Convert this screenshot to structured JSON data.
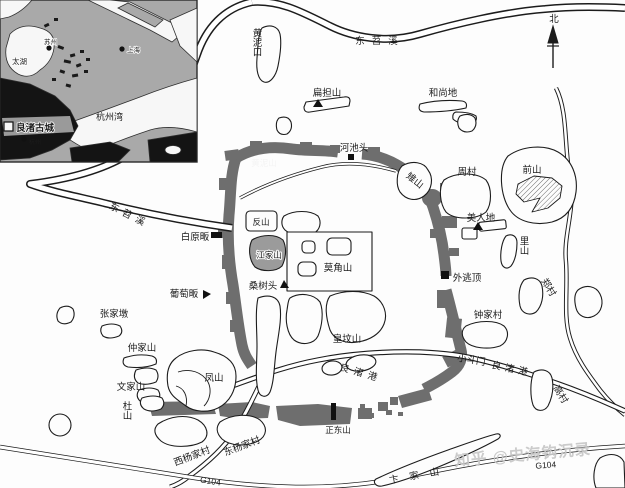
{
  "compass": {
    "north": "北"
  },
  "rivers": {
    "dongtiaoxi_top": "东苕溪",
    "dongtiaoxi_left": "东苕溪",
    "liangzhugang_mid": "良渚港",
    "liangzhugang_right": "良渚港"
  },
  "roads": {
    "g104_left": "G104",
    "g104_right": "G104"
  },
  "places": {
    "huangnikou": "黄泥口",
    "biandanshan": "扁担山",
    "heshangdi": "和尚地",
    "hechitou": "河池头",
    "huangnishan": "黄泥山",
    "zhishan": "雉山",
    "zhoucun": "周村",
    "qianshan": "前山",
    "meirendi": "美人地",
    "lishan": "里山",
    "baiyuanfan": "白原畈",
    "fanshan": "反山",
    "jiangjiashan": "江家山",
    "mojiaoshan": "莫角山",
    "putaofan": "葡萄畈",
    "sangshutou": "桑树头",
    "waitaoding": "外逃顶",
    "zhengcun": "郑村",
    "zhangjiadun": "张家墩",
    "huangfenshan": "皇坟山",
    "zhongjiacun": "钟家村",
    "zhongjiashan": "仲家山",
    "wenjiashan": "文家山",
    "dushan": "杜山",
    "fengshan": "凤山",
    "xiaodoumen": "小斗门",
    "gaocun": "高村",
    "xiyangjiacun": "西杨家村",
    "dongyangjiacun": "东杨家村",
    "zhengdongshan": "正东山",
    "bianjiashan": "卞家山"
  },
  "inset": {
    "taihu": "太湖",
    "suzhou": "苏州",
    "shanghai": "上海",
    "hangzhouwan": "杭州湾",
    "liangzhu_gucheng": "良渚古城",
    "hangzhou": "杭州"
  },
  "watermark": {
    "text": "知乎 @史海钩沉录"
  },
  "colors": {
    "wall": "#6e6e6e",
    "ink": "#1c1c1c",
    "inset_land": "#a9a9a9",
    "inset_dark": "#141414",
    "watermark": "#c7c7c7"
  }
}
